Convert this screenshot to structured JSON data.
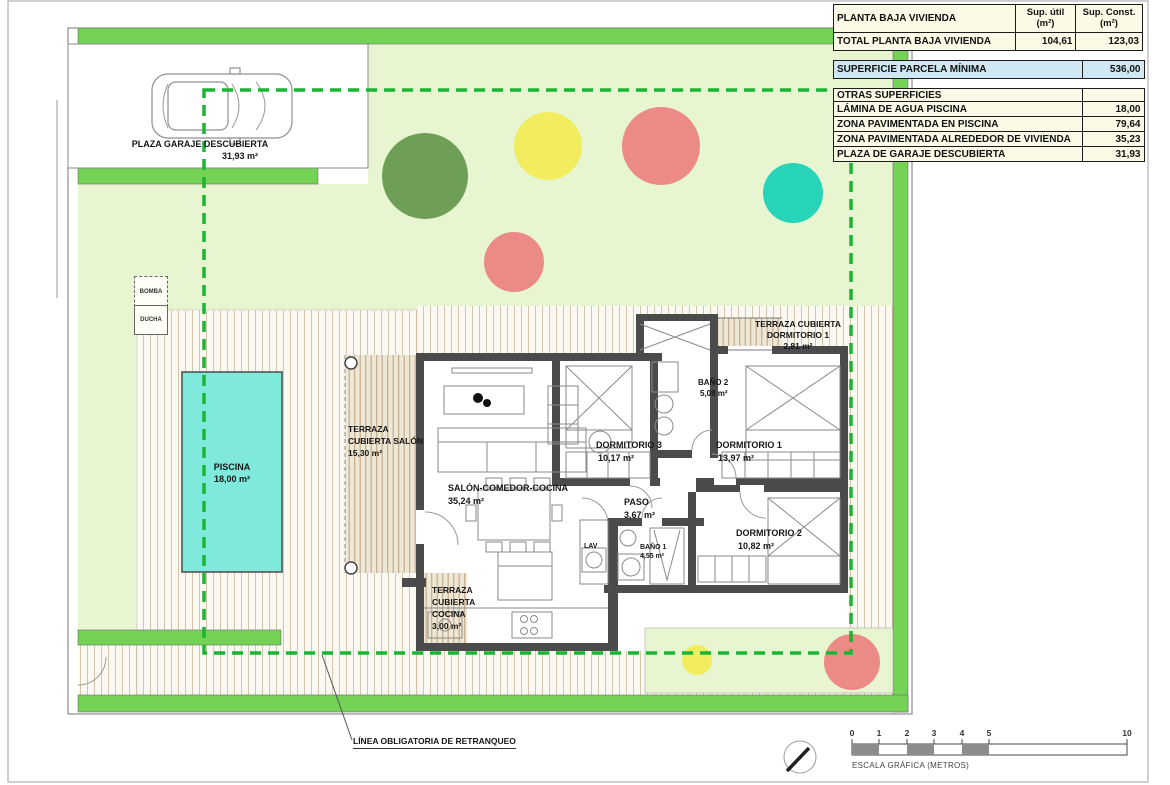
{
  "plan": {
    "garage": {
      "name": "PLAZA GARAJE DESCUBIERTA",
      "area": "31,93 m²"
    },
    "bomba": "BOMBA",
    "ducha": "DUCHA",
    "piscina": {
      "name": "PISCINA",
      "area": "18,00 m²"
    },
    "terraza_salon": {
      "line1": "TERRAZA",
      "line2": "CUBIERTA SALÓN",
      "area": "15,30 m²"
    },
    "salon": {
      "name": "SALÓN-COMEDOR-COCINA",
      "area": "35,24 m²"
    },
    "dormitorio3": {
      "name": "DORMITORIO 3",
      "area": "10,17 m²"
    },
    "dormitorio1": {
      "name": "DORMITORIO 1",
      "area": "13,97 m²"
    },
    "dormitorio2": {
      "name": "DORMITORIO 2",
      "area": "10,82 m²"
    },
    "bano2": {
      "name": "BAÑO 2",
      "area": "5,08 m²"
    },
    "bano1": {
      "name": "BAÑO 1",
      "area": "4,55 m²"
    },
    "paso": {
      "name": "PASO",
      "area": "3,67 m²"
    },
    "lav": "LAV",
    "terraza_dorm1": {
      "line1": "TERRAZA CUBIERTA",
      "line2": "DORMITORIO 1",
      "area": "2,81 m²"
    },
    "terraza_cocina": {
      "line1": "TERRAZA",
      "line2": "CUBIERTA",
      "line3": "COCINA",
      "area": "3,00 m²"
    },
    "setback": "LÍNEA OBLIGATORIA DE RETRANQUEO"
  },
  "table": {
    "header": {
      "col1": "PLANTA BAJA VIVIENDA",
      "col2": "Sup. útil\n(m²)",
      "col3": "Sup. Const.\n(m²)"
    },
    "total": {
      "label": "TOTAL PLANTA BAJA VIVIENDA",
      "util": "104,61",
      "const": "123,03"
    },
    "parcela": {
      "label": "SUPERFICIE PARCELA MÍNIMA",
      "value": "536,00"
    },
    "otras_header": "OTRAS SUPERFICIES",
    "otras": [
      {
        "label": "LÁMINA DE AGUA PISCINA",
        "value": "18,00"
      },
      {
        "label": "ZONA PAVIMENTADA EN PISCINA",
        "value": "79,64"
      },
      {
        "label": "ZONA PAVIMENTADA ALREDEDOR DE VIVIENDA",
        "value": "35,23"
      },
      {
        "label": "PLAZA DE GARAJE DESCUBIERTA",
        "value": "31,93"
      }
    ]
  },
  "scale_bar": {
    "ticks": [
      "0",
      "1",
      "2",
      "3",
      "4",
      "5",
      "10"
    ],
    "caption": "ESCALA GRÁFICA (METROS)"
  },
  "colors": {
    "hedge": "#74d355",
    "garden": "#e7f5d0",
    "pool": "#7fe9db",
    "dashed": "#1cb434",
    "treeGreen": "#6f9e56",
    "treeYellow": "#f2ec5f",
    "treeSalmon": "#ec8b85",
    "treeTeal": "#27d4b7",
    "tablebg": "#fbfae7",
    "tableblue": "#cfe8f4",
    "wall": "#4b4b4b",
    "scaleGray": "#8c8c8c"
  }
}
